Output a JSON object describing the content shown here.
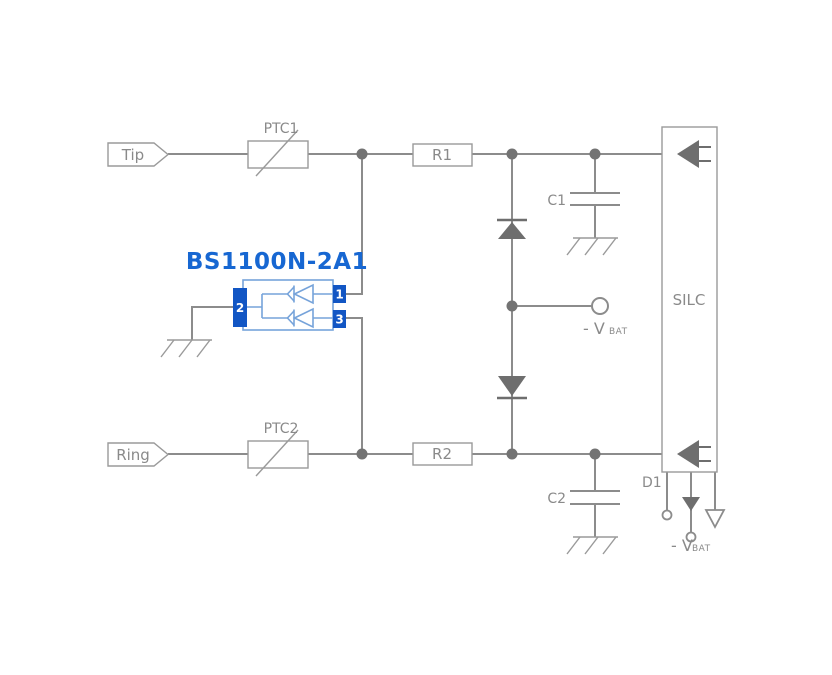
{
  "diagram": {
    "type": "circuit-schematic",
    "labels": {
      "tip": "Tip",
      "ring": "Ring",
      "ptc1": "PTC1",
      "ptc2": "PTC2",
      "r1": "R1",
      "r2": "R2",
      "c1": "C1",
      "c2": "C2",
      "silc": "SILC",
      "d1": "D1",
      "vbat_prefix": "- V",
      "vbat_sub": "BAT"
    },
    "component": {
      "title": "BS1100N-2A1",
      "pin1": "1",
      "pin2": "2",
      "pin3": "3"
    },
    "colors": {
      "wire_gray": "#8C8C8C",
      "dark_gray_fill": "#6E6E6E",
      "label_gray": "#8A8A8A",
      "title_blue": "#1767D2",
      "pin_blue": "#1256C4",
      "symbol_blue": "#76A3DA"
    }
  }
}
